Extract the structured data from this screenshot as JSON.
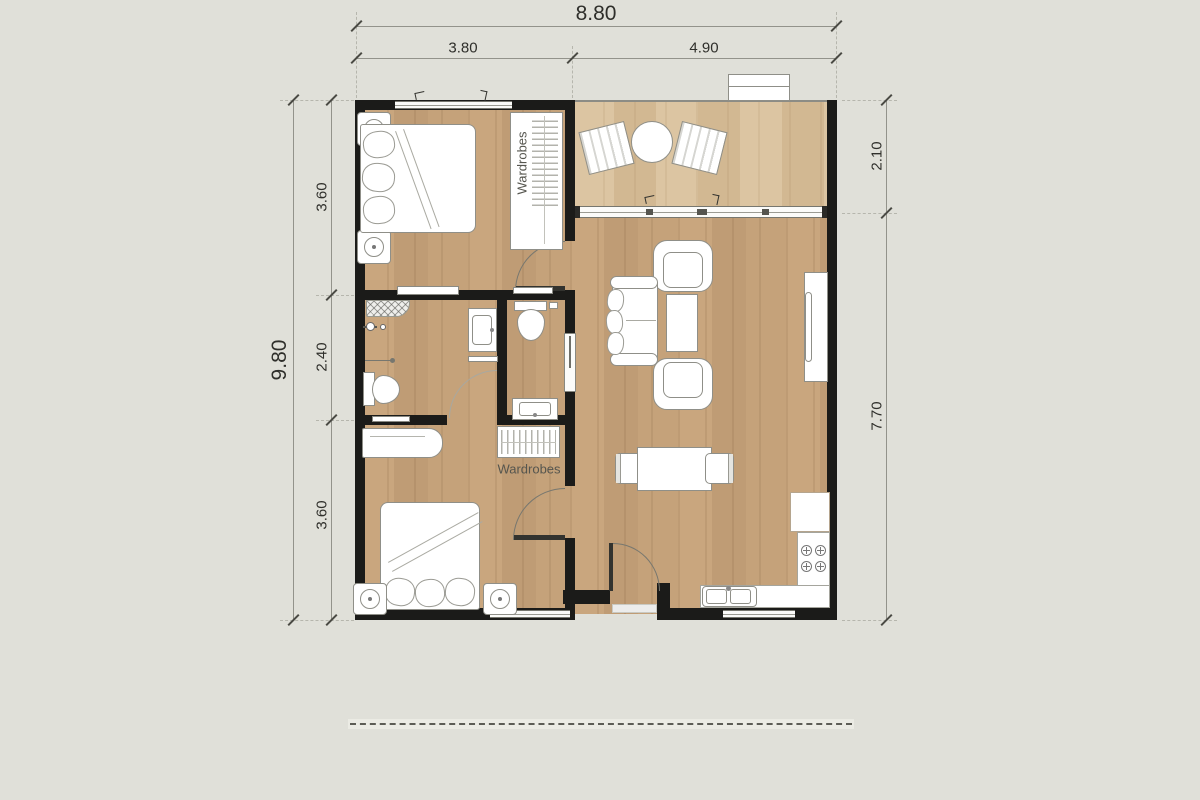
{
  "title": "apartment-floor-plan",
  "dimensions": {
    "top": {
      "overall": "8.80",
      "segments": [
        "3.80",
        "4.90"
      ]
    },
    "left": {
      "overall": "9.80",
      "segments": [
        "3.60",
        "2.40",
        "3.60"
      ]
    },
    "right": {
      "segments": [
        "2.10",
        "7.70"
      ]
    }
  },
  "labels": {
    "wardrobe_bedroom1": "Wardrobes",
    "wardrobe_bedroom2": "Wardrobes"
  },
  "colors": {
    "background": "#e0e0d9",
    "wall": "#1b1b19",
    "wood_floor": "#c6a37c",
    "balcony_floor": "#d8c09d",
    "furniture_fill": "#ffffff",
    "furniture_outline": "#8f8f88",
    "dimension_text": "#2f2f2b"
  }
}
